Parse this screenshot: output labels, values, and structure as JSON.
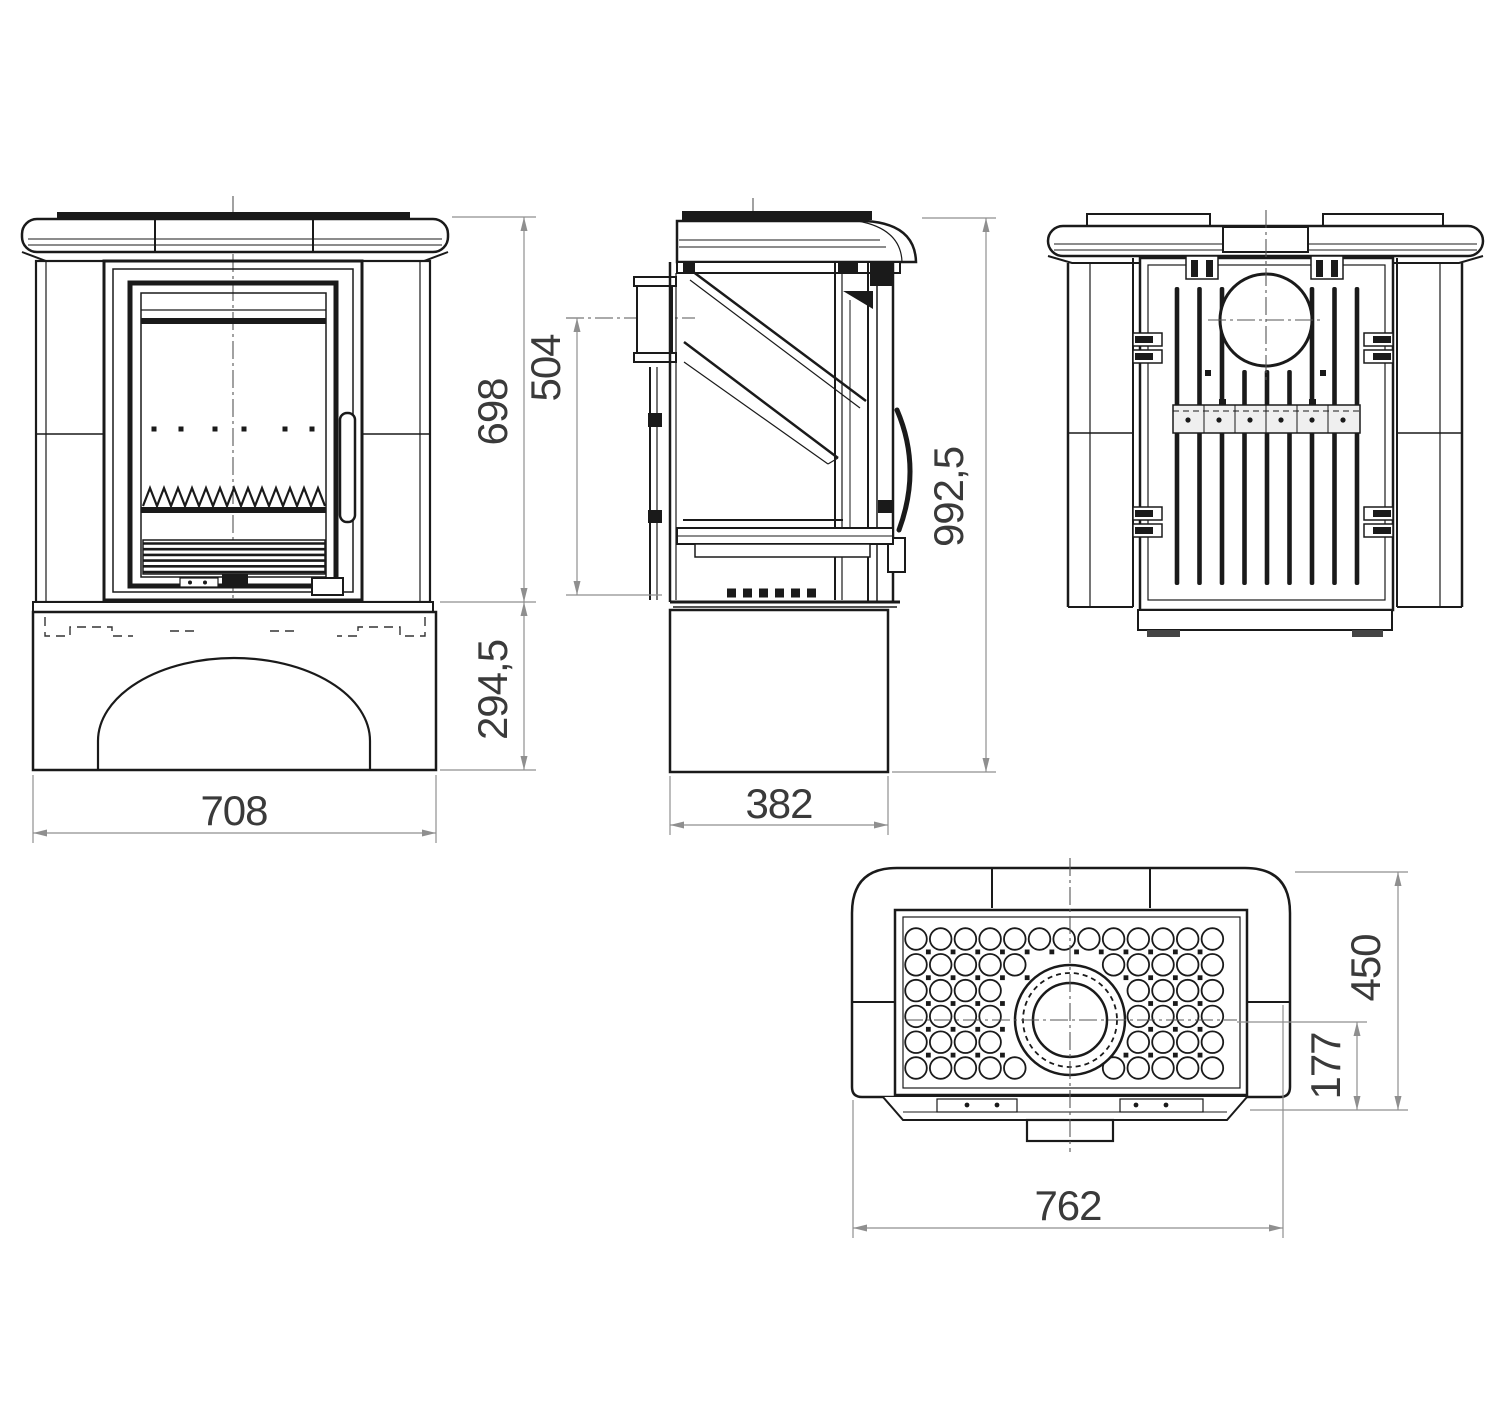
{
  "document": {
    "type": "technical-drawing",
    "background": "#ffffff"
  },
  "colors": {
    "line": "#1a1a1a",
    "dimension_line": "#8f8f8f",
    "dimension_text": "#3a3a3a",
    "light_fill": "#efefef",
    "dark_fill": "#444444"
  },
  "dimensions": {
    "front_width": "708",
    "front_upper_height": "698",
    "front_base_height": "294,5",
    "side_depth": "382",
    "side_flue_center_height": "504",
    "side_total_height": "992,5",
    "top_width": "762",
    "top_depth": "450",
    "top_flue_center_offset": "177"
  }
}
